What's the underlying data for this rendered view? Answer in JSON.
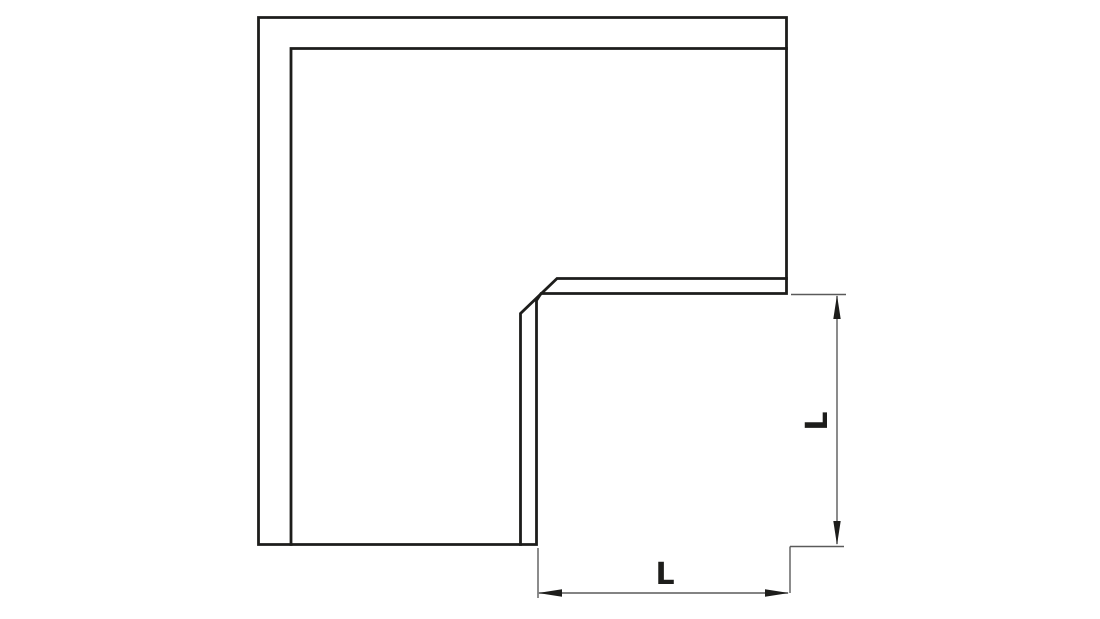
{
  "drawing": {
    "kind": "technical-dimension-diagram",
    "part": "flat-angle-elbow",
    "labels": {
      "horizontal_dimension": "L",
      "vertical_dimension": "L"
    },
    "colors": {
      "background": "#ffffff",
      "outline": "#1d1d1b",
      "dimension_line": "#5a5a5a"
    }
  }
}
